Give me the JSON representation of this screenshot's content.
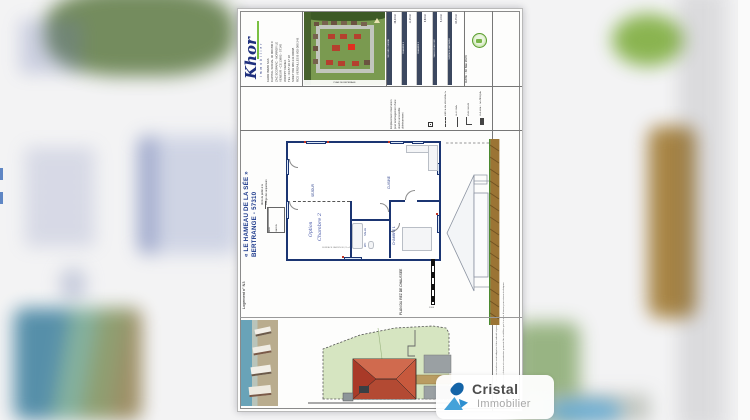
{
  "watermark": {
    "brand": "Cristal",
    "sub": "Immobilier"
  },
  "agency": {
    "logo": "Khor",
    "logo_sub": "i m m o b i l i e r",
    "lines": [
      "KHOR IMMO SAS",
      "CAPITAL SOCIAL 40 000 800 €",
      "ZAC ECOPARC - NORROY LE",
      "VENEUR - CS 13882 - 57145",
      "WOIPPY CEDEX",
      "TEL : 03 87 20 17 18",
      "SIRET 802 080 243 00008",
      "RCS VERSAILLES B 802 080 243"
    ],
    "plan_caption": "PLAN DE REPERAGE"
  },
  "titleblock": {
    "date": "DATE : 30 Mai 2023",
    "disclaimer_1": "Document non contractuel : les cotes et surfaces sont indiquées à titre indicatif et peuvent varier en fonction des contraintes techniques du chantier.",
    "disclaimer_2": "Les implantations des équipements, cloisons et menuiseries pourront être modifiées par le maître d'œuvre pour raisons techniques."
  },
  "surface_table": {
    "rows": [
      {
        "label": "SEJOUR / CUISINE",
        "value": "38,20 m²"
      },
      {
        "label": "CHAMBRE 1",
        "value": "11,35 m²"
      },
      {
        "label": "CHAMBRE 2",
        "value": "9,80 m²"
      },
      {
        "label": "SALLE D'EAU / WC",
        "value": "5,10 m²"
      },
      {
        "label": "SURFACE HABITABLE",
        "value": "64,45 m²"
      }
    ]
  },
  "legend": {
    "items": [
      "LIMITE DE PROPRIETE",
      "CLOTURE",
      "PORTILLON",
      "COFFRET TECHNIQUE"
    ]
  },
  "notes": {
    "douche_1": "Emplacement réservation",
    "douche_2": "pour aménagement d'une",
    "douche_3": "douche accessible",
    "douche_4": "ultérieurement",
    "abris_1": "Abris de jardin à la",
    "abris_2": "charge des acquéreurs"
  },
  "project": {
    "title": "« LE HAMEAU DE LA SÉE »",
    "city": "BERTRANGE - 57310",
    "unit": "Logement n° N3",
    "plan_label": "PLAN DU REZ DE CHAUSSEE",
    "scale": "1/100"
  },
  "rooms": {
    "sejour": "SEJOUR",
    "cuisine": "CUISINE",
    "chambre1": "CHAMBRE 1",
    "salle": "SALLE",
    "wc": "WC",
    "option_script_1": "Option",
    "option_script_2": "Chambre 2",
    "jardin_1": "ABRI",
    "jardin_2": "JARDIN",
    "dim_note": "SURFACE JARDIN 80,21 m²"
  },
  "colors": {
    "navy_title": "#1d3a8c",
    "wall_navy": "#1b3572",
    "logo_green": "#7ac043",
    "roof_red": "#c7593d",
    "brand_blue": "#2e8fd0"
  }
}
